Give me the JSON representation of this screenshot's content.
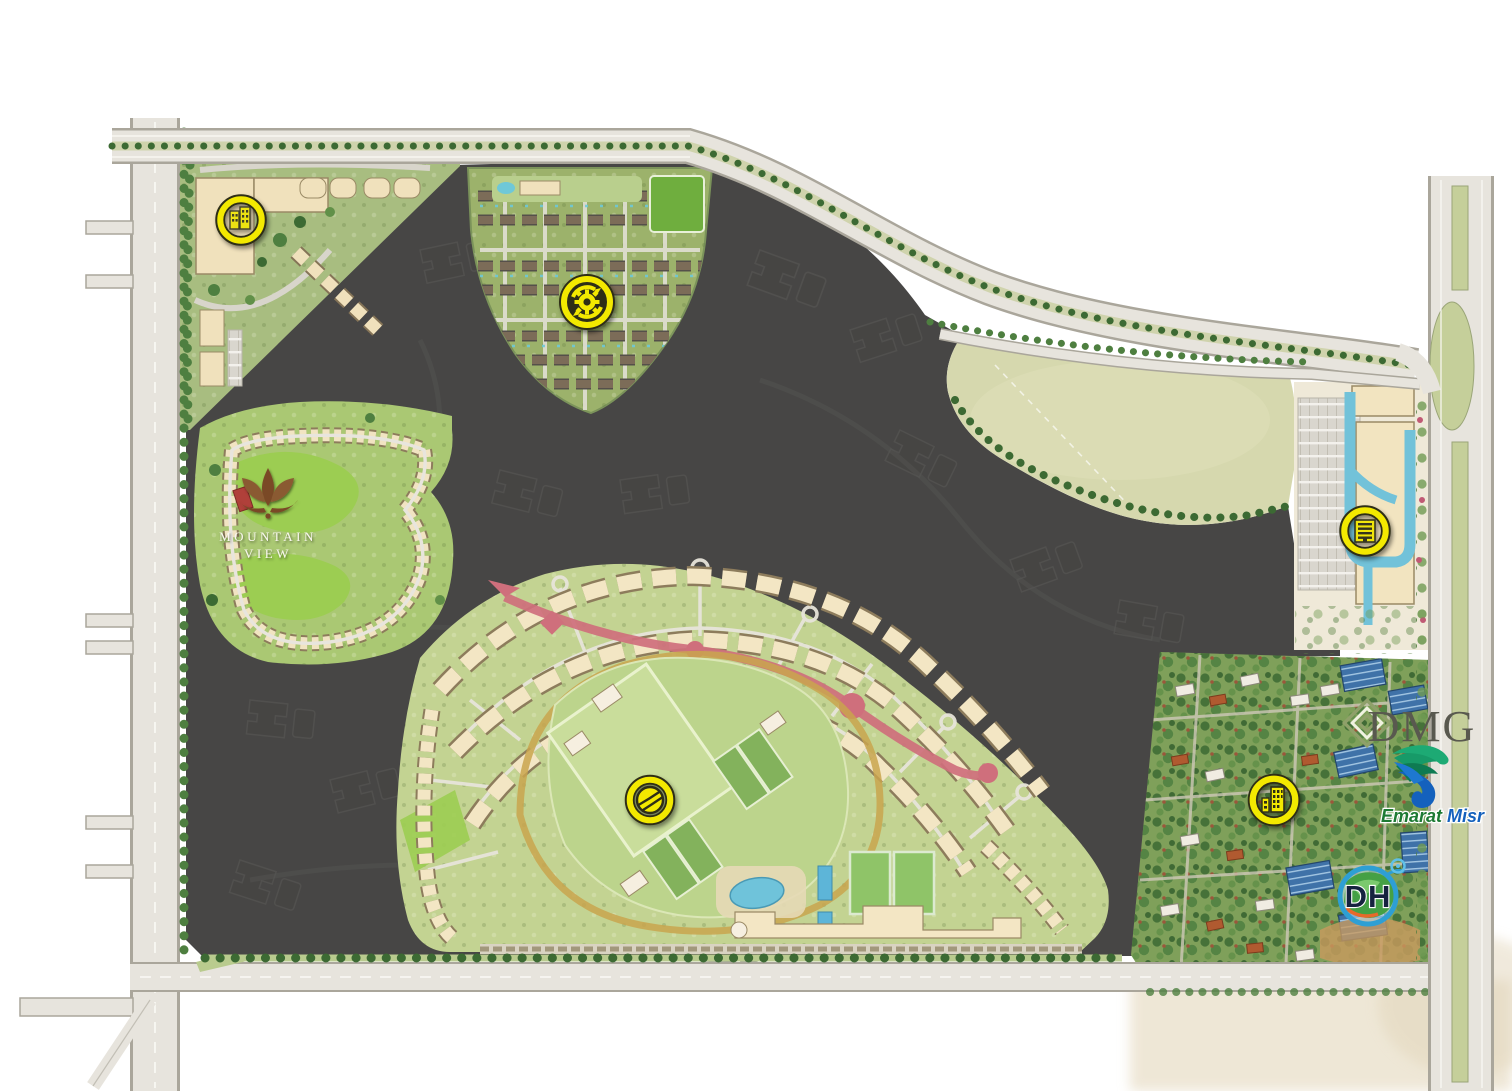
{
  "map": {
    "type": "real-estate-master-plan",
    "logos": {
      "mountain_view": {
        "line1": "MOUNTAIN",
        "line2": "VIEW"
      },
      "dmg": {
        "text": "DMG"
      },
      "emarat_misr": {
        "word1": "Emarat",
        "word2": "Misr"
      },
      "dh": {
        "text": "DH"
      }
    },
    "markers": [
      {
        "name": "map-marker-retail",
        "icon": "buildings-icon",
        "style": "ring",
        "x": 241,
        "y": 220
      },
      {
        "name": "map-marker-construction",
        "icon": "gear-arrows-icon",
        "style": "solid",
        "x": 587,
        "y": 302
      },
      {
        "name": "map-marker-offices",
        "icon": "office-building-icon",
        "style": "ring",
        "x": 1365,
        "y": 531
      },
      {
        "name": "map-marker-sports",
        "icon": "tennis-ball-icon",
        "style": "ring",
        "x": 650,
        "y": 800
      },
      {
        "name": "map-marker-apartments",
        "icon": "tower-building-icon",
        "style": "ring",
        "x": 1274,
        "y": 800
      }
    ],
    "colors": {
      "marker_yellow": "#f3e900",
      "marker_outline": "#2e2e18",
      "dark_parcel": "#474645",
      "road_fill": "#e7e4dd",
      "road_casing": "#aaa69b",
      "landscape_green": "#b0c386",
      "golf_green": "#9ccd52",
      "building_cream": "#f3e6c4",
      "water_blue": "#72c2d9",
      "boulevard_pink": "#cf6f7c",
      "field_sage": "#d6d8ae",
      "district_green": "#7fa05a",
      "terracotta": "#b05a30",
      "solar_blue": "#3f72a8"
    }
  }
}
